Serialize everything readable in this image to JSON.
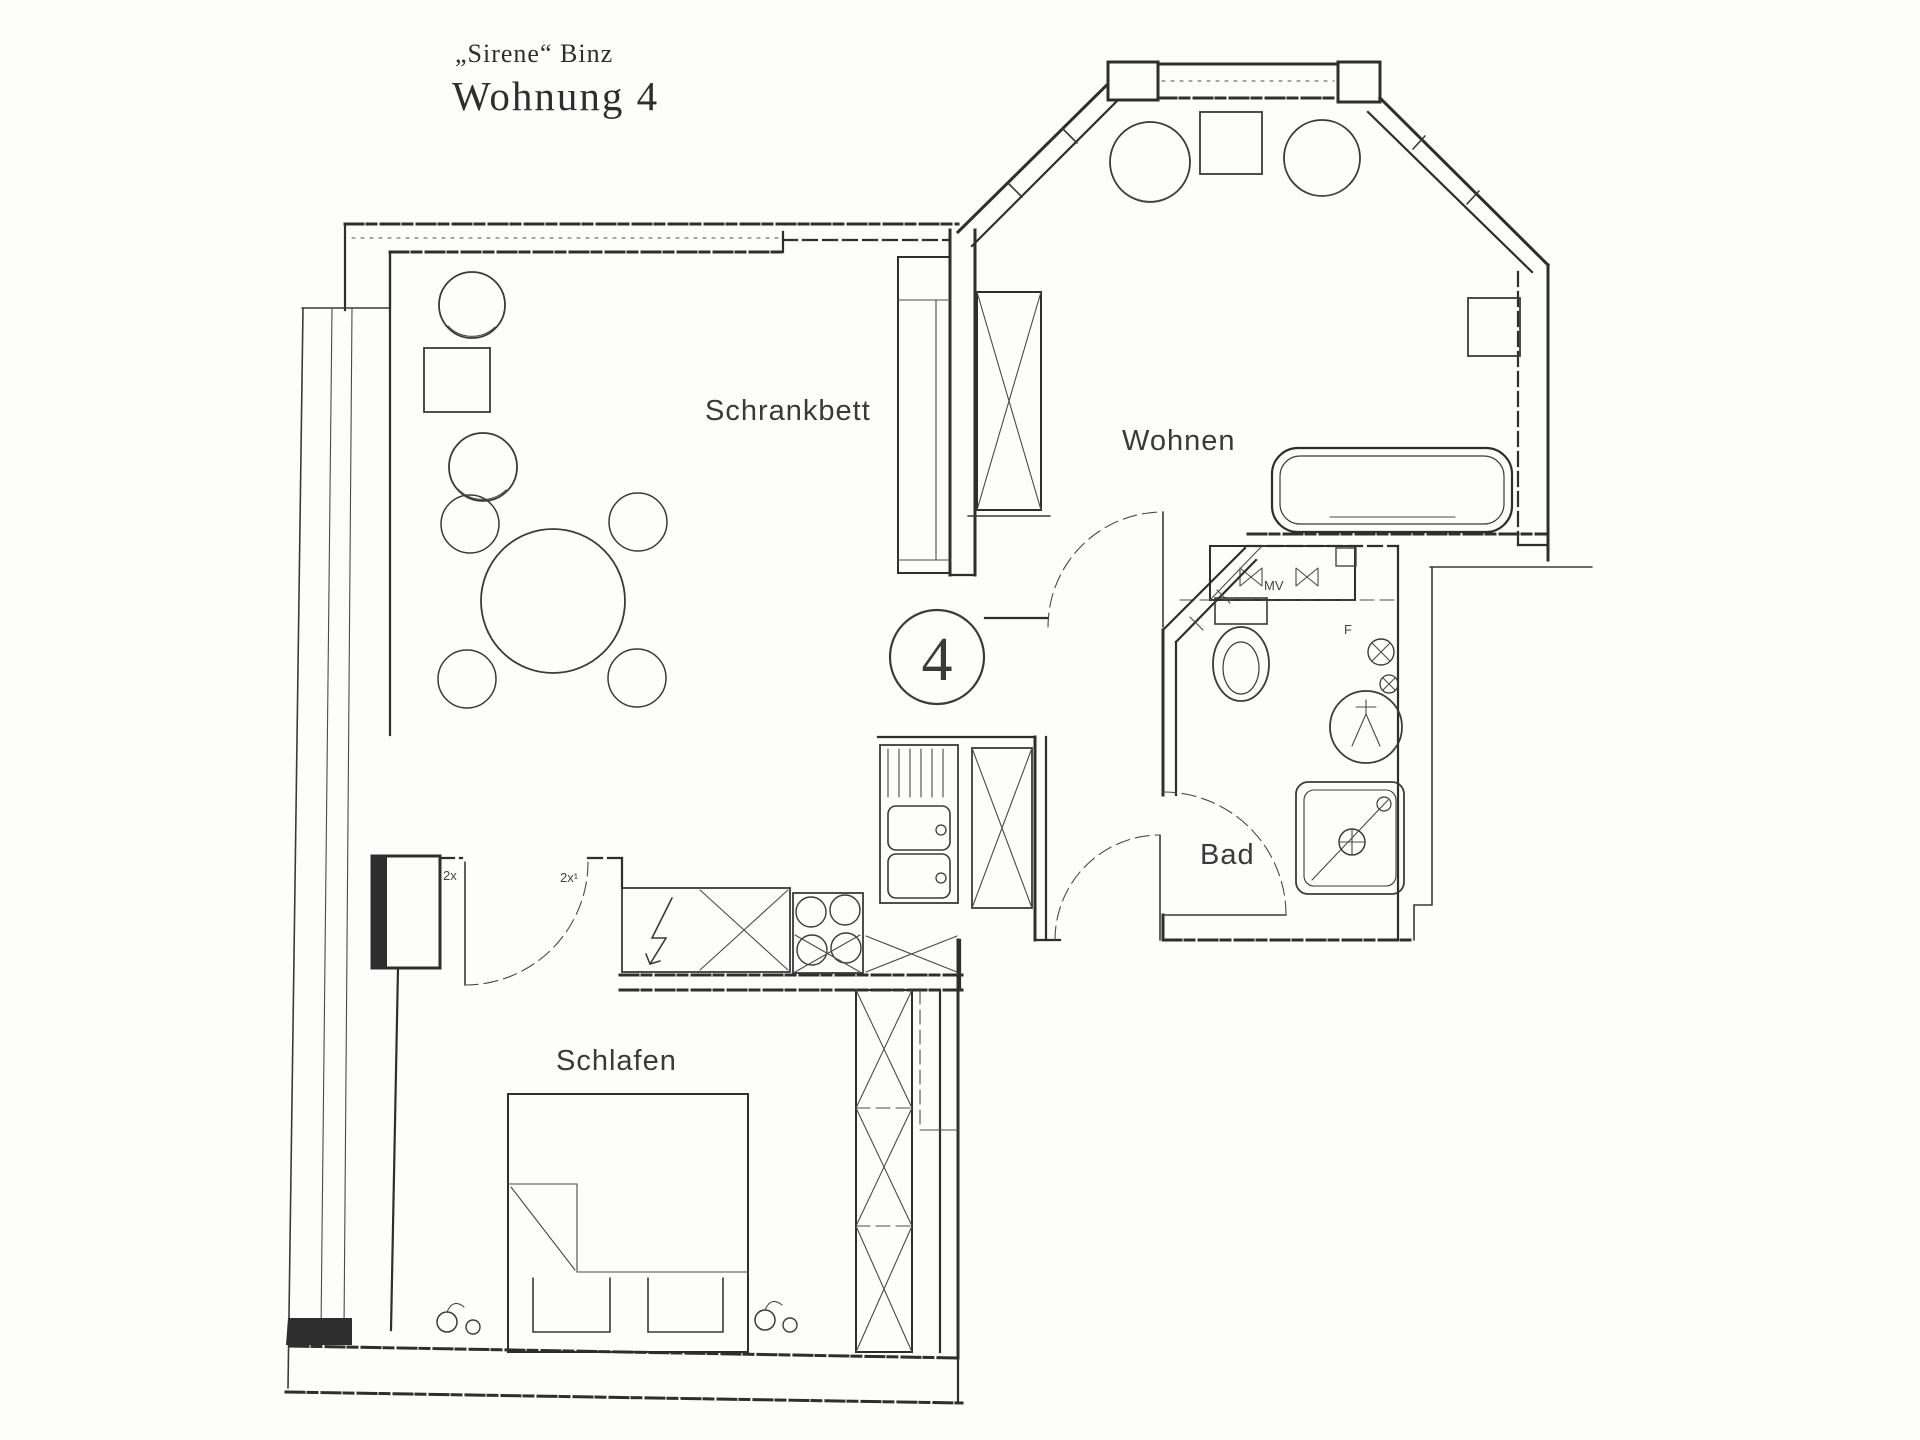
{
  "page": {
    "paper": "#fdfdfc",
    "ink": "#2e2e2e"
  },
  "title": {
    "project": "„Sirene“ Binz",
    "unit": "Wohnung 4"
  },
  "unit_number": "4",
  "room_labels": {
    "schrankbett": "Schrankbett",
    "wohnen": "Wohnen",
    "bad": "Bad",
    "schlafen": "Schlafen"
  },
  "annotations": {
    "door_count_left": "2x",
    "door_count_right": "2x¹",
    "shaft": "MV",
    "fuse": "F"
  }
}
